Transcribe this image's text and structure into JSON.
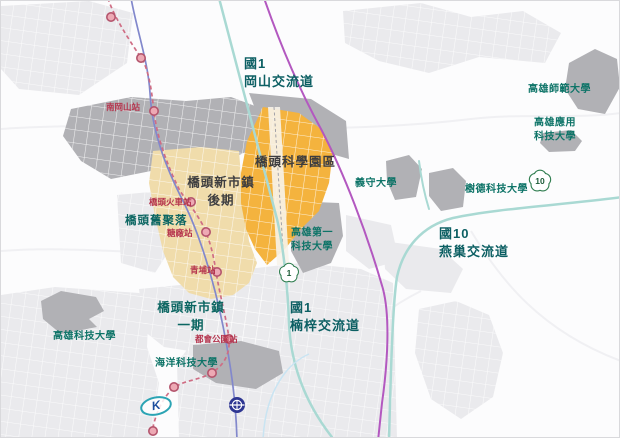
{
  "labels": {
    "gangshan_interchange": "國1\n岡山交流道",
    "nangangshan_station": "南岡山站",
    "science_park": "橋頭科學園區",
    "new_town_phase2": "橋頭新市鎮\n後期",
    "old_settlement": "橋頭舊聚落",
    "qiaotou_train_station": "橋頭火車站",
    "sugar_refinery_station": "糖廠站",
    "qingpu_station": "青埔站",
    "first_univ": "高雄第一\n科技大學",
    "nanzi_interchange": "國1\n楠梓交流道",
    "new_town_phase1": "橋頭新市鎮\n一期",
    "metro_park_station": "都會公園站",
    "marine_univ": "海洋科技大學",
    "kaohsiung_univ": "高雄科技大學",
    "normal_univ": "高雄師範大學",
    "applied_univ": "高雄應用\n科技大學",
    "ishou_univ": "義守大學",
    "shute_univ": "樹德科技大學",
    "yanchao_interchange": "國10\n燕巢交流道",
    "krt_logo": "K"
  },
  "shields": {
    "freeway1": "1",
    "freeway10": "10"
  },
  "colors": {
    "science_park_fill": "#f4b33e",
    "new_town_fill": "#f0dcab",
    "campus_fill": "#b1b1b5",
    "urban_fill": "#eaeaed",
    "mrt_line": "#cf6d84",
    "mrt_station_fill": "#eda9b4",
    "tra_line": "#8288cc",
    "thsr_line": "#b358c0",
    "freeway_line": "#a9d9d3",
    "shield_green": "#2f7d4f",
    "label_teal": "#0c5f63",
    "label_red": "#b5344d",
    "label_charcoal": "#3d3d3f"
  }
}
